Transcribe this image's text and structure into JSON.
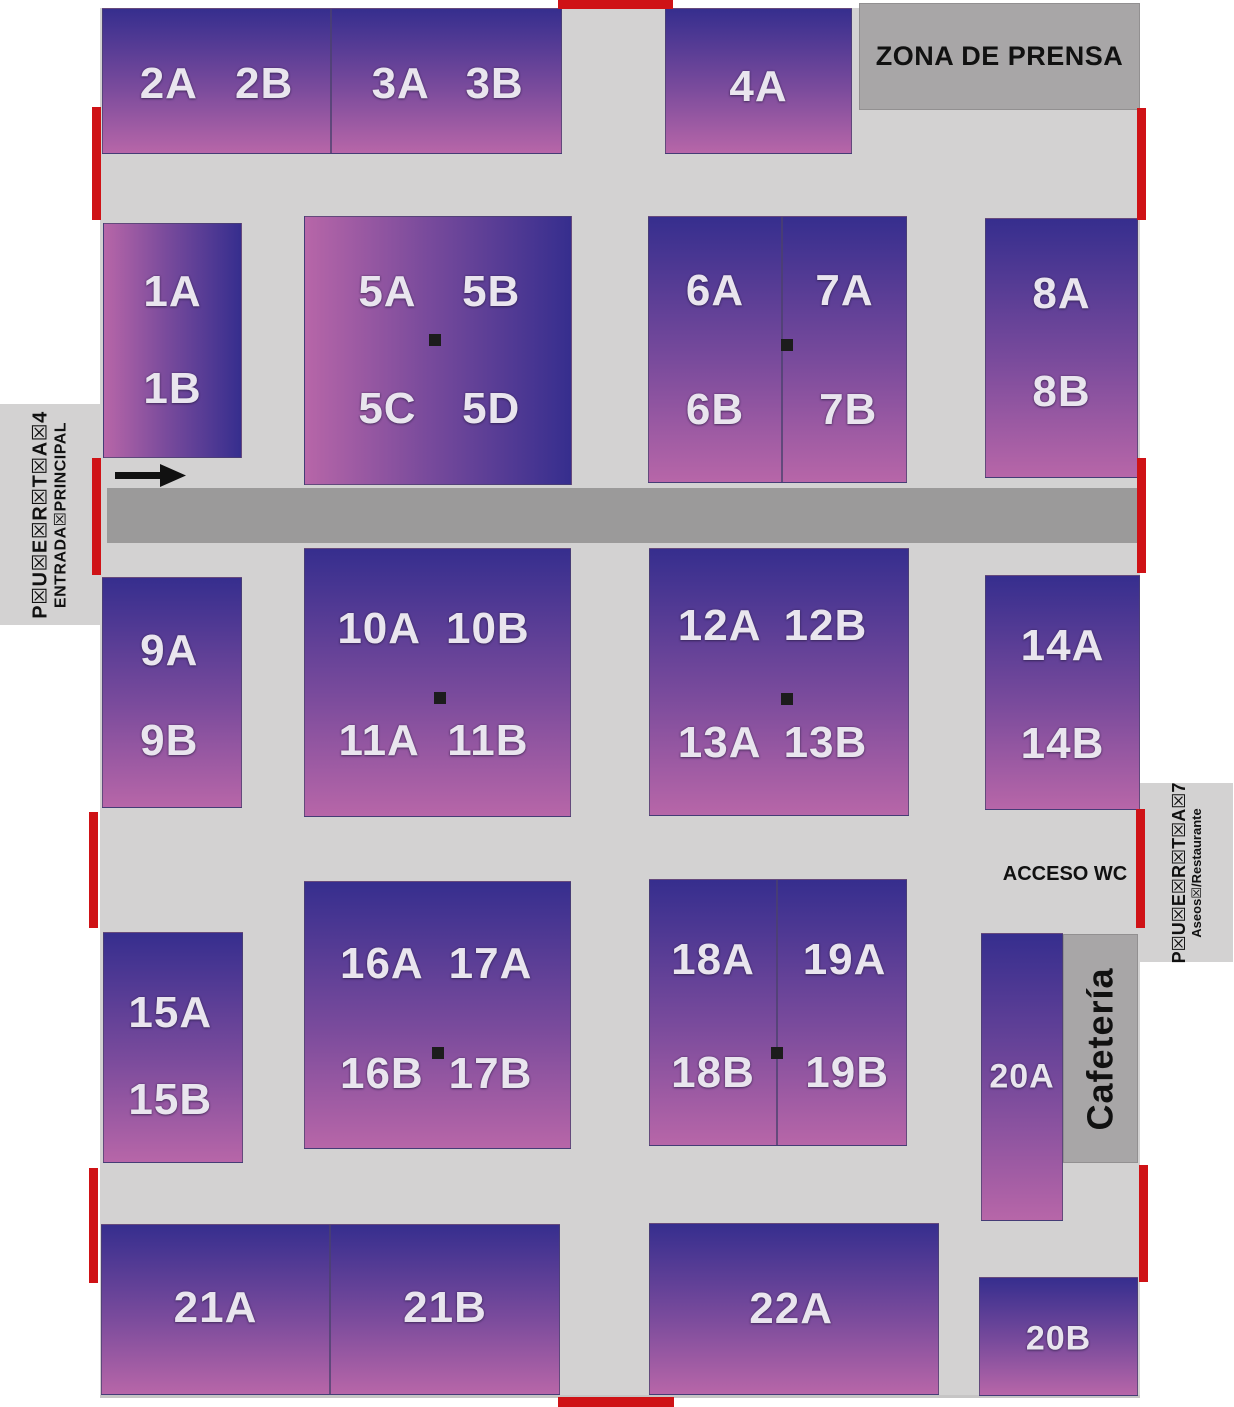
{
  "map": {
    "colors": {
      "floor_gray": "#d3d2d2",
      "corridor_gray": "#9b9a9a",
      "zone_gray": "#a8a6a7",
      "stand_gradient_dark": "#362e8e",
      "stand_gradient_pink": "#b766a8",
      "label_white": "#e9e5ee",
      "door_red": "#cf1216"
    },
    "zones": {
      "press": {
        "label": "ZONA DE PRENSA"
      },
      "cafeteria": {
        "label": "Cafetería"
      },
      "acceso_wc": {
        "label": "ACCESO WC"
      },
      "door4": {
        "line1": "P☒U☒E☒R☒T☒A☒4",
        "line2": "ENTRADA☒PRINCIPAL"
      },
      "door7": {
        "line1": "P☒U☒E☒R☒T☒A☒7",
        "line2": "Aseos☒/Restaurante"
      }
    },
    "stands": [
      {
        "id": "2",
        "x": 102,
        "y": 8,
        "w": 229,
        "h": 146,
        "grad": "v",
        "fs": 44,
        "labels": [
          {
            "t": "2A",
            "x": 29,
            "y": 52
          },
          {
            "t": "2B",
            "x": 71,
            "y": 52
          }
        ]
      },
      {
        "id": "3",
        "x": 331,
        "y": 8,
        "w": 231,
        "h": 146,
        "grad": "v",
        "fs": 44,
        "labels": [
          {
            "t": "3A",
            "x": 30,
            "y": 52
          },
          {
            "t": "3B",
            "x": 71,
            "y": 52
          }
        ]
      },
      {
        "id": "4",
        "x": 665,
        "y": 8,
        "w": 187,
        "h": 146,
        "grad": "v",
        "fs": 44,
        "labels": [
          {
            "t": "4A",
            "x": 50,
            "y": 54
          }
        ]
      },
      {
        "id": "1",
        "x": 103,
        "y": 223,
        "w": 139,
        "h": 235,
        "grad": "h",
        "fs": 44,
        "labels": [
          {
            "t": "1A",
            "x": 50,
            "y": 29
          },
          {
            "t": "1B",
            "x": 50,
            "y": 71
          }
        ]
      },
      {
        "id": "5",
        "x": 304,
        "y": 216,
        "w": 268,
        "h": 269,
        "grad": "h",
        "fs": 44,
        "labels": [
          {
            "t": "5A",
            "x": 31,
            "y": 28
          },
          {
            "t": "5B",
            "x": 70,
            "y": 28
          },
          {
            "t": "5C",
            "x": 31,
            "y": 72
          },
          {
            "t": "5D",
            "x": 70,
            "y": 72
          }
        ]
      },
      {
        "id": "6",
        "x": 648,
        "y": 216,
        "w": 134,
        "h": 267,
        "grad": "v",
        "fs": 44,
        "labels": [
          {
            "t": "6A",
            "x": 50,
            "y": 28
          },
          {
            "t": "6B",
            "x": 50,
            "y": 73
          }
        ]
      },
      {
        "id": "7",
        "x": 782,
        "y": 216,
        "w": 125,
        "h": 267,
        "grad": "v",
        "fs": 44,
        "labels": [
          {
            "t": "7A",
            "x": 50,
            "y": 28
          },
          {
            "t": "7B",
            "x": 53,
            "y": 73
          }
        ]
      },
      {
        "id": "8",
        "x": 985,
        "y": 218,
        "w": 153,
        "h": 260,
        "grad": "v",
        "fs": 44,
        "labels": [
          {
            "t": "8A",
            "x": 50,
            "y": 29
          },
          {
            "t": "8B",
            "x": 50,
            "y": 67
          }
        ]
      },
      {
        "id": "9",
        "x": 102,
        "y": 577,
        "w": 140,
        "h": 231,
        "grad": "v",
        "fs": 44,
        "labels": [
          {
            "t": "9A",
            "x": 48,
            "y": 32
          },
          {
            "t": "9B",
            "x": 48,
            "y": 71
          }
        ]
      },
      {
        "id": "10-11",
        "x": 304,
        "y": 548,
        "w": 267,
        "h": 269,
        "grad": "v",
        "fs": 44,
        "labels": [
          {
            "t": "10A",
            "x": 28,
            "y": 30
          },
          {
            "t": "10B",
            "x": 69,
            "y": 30
          },
          {
            "t": "11A",
            "x": 28,
            "y": 72
          },
          {
            "t": "11B",
            "x": 69,
            "y": 72
          }
        ]
      },
      {
        "id": "12-13",
        "x": 649,
        "y": 548,
        "w": 260,
        "h": 268,
        "grad": "v",
        "fs": 44,
        "labels": [
          {
            "t": "12A",
            "x": 27,
            "y": 29
          },
          {
            "t": "12B",
            "x": 68,
            "y": 29
          },
          {
            "t": "13A",
            "x": 27,
            "y": 73
          },
          {
            "t": "13B",
            "x": 68,
            "y": 73
          }
        ]
      },
      {
        "id": "14",
        "x": 985,
        "y": 575,
        "w": 155,
        "h": 235,
        "grad": "v",
        "fs": 44,
        "labels": [
          {
            "t": "14A",
            "x": 50,
            "y": 30
          },
          {
            "t": "14B",
            "x": 50,
            "y": 72
          }
        ]
      },
      {
        "id": "15",
        "x": 103,
        "y": 932,
        "w": 140,
        "h": 231,
        "grad": "v",
        "fs": 44,
        "labels": [
          {
            "t": "15A",
            "x": 48,
            "y": 35
          },
          {
            "t": "15B",
            "x": 48,
            "y": 73
          }
        ]
      },
      {
        "id": "16-17",
        "x": 304,
        "y": 881,
        "w": 267,
        "h": 268,
        "grad": "v",
        "fs": 44,
        "labels": [
          {
            "t": "16A",
            "x": 29,
            "y": 31
          },
          {
            "t": "17A",
            "x": 70,
            "y": 31
          },
          {
            "t": "16B",
            "x": 29,
            "y": 72
          },
          {
            "t": "17B",
            "x": 70,
            "y": 72
          }
        ]
      },
      {
        "id": "18",
        "x": 649,
        "y": 879,
        "w": 128,
        "h": 267,
        "grad": "v",
        "fs": 44,
        "labels": [
          {
            "t": "18A",
            "x": 50,
            "y": 30
          },
          {
            "t": "18B",
            "x": 50,
            "y": 73
          }
        ]
      },
      {
        "id": "19",
        "x": 777,
        "y": 879,
        "w": 130,
        "h": 267,
        "grad": "v",
        "fs": 44,
        "labels": [
          {
            "t": "19A",
            "x": 52,
            "y": 30
          },
          {
            "t": "19B",
            "x": 54,
            "y": 73
          }
        ]
      },
      {
        "id": "20A",
        "x": 981,
        "y": 933,
        "w": 82,
        "h": 288,
        "grad": "v",
        "fs": 34,
        "labels": [
          {
            "t": "20A",
            "x": 50,
            "y": 50
          }
        ]
      },
      {
        "id": "21A",
        "x": 101,
        "y": 1224,
        "w": 229,
        "h": 171,
        "grad": "v",
        "fs": 44,
        "labels": [
          {
            "t": "21A",
            "x": 50,
            "y": 49
          }
        ]
      },
      {
        "id": "21B",
        "x": 330,
        "y": 1224,
        "w": 230,
        "h": 171,
        "grad": "v",
        "fs": 44,
        "labels": [
          {
            "t": "21B",
            "x": 50,
            "y": 49
          }
        ]
      },
      {
        "id": "22",
        "x": 649,
        "y": 1223,
        "w": 290,
        "h": 172,
        "grad": "v",
        "fs": 44,
        "labels": [
          {
            "t": "22A",
            "x": 49,
            "y": 50
          }
        ]
      },
      {
        "id": "20B",
        "x": 979,
        "y": 1277,
        "w": 159,
        "h": 119,
        "grad": "v",
        "fs": 34,
        "labels": [
          {
            "t": "20B",
            "x": 50,
            "y": 52
          }
        ]
      }
    ],
    "pillars": [
      {
        "x": 435,
        "y": 340
      },
      {
        "x": 787,
        "y": 345
      },
      {
        "x": 440,
        "y": 698
      },
      {
        "x": 787,
        "y": 699
      },
      {
        "x": 438,
        "y": 1053
      },
      {
        "x": 777,
        "y": 1053
      }
    ],
    "doors": [
      {
        "x": 558,
        "y": 0,
        "w": 115,
        "h": 9
      },
      {
        "x": 558,
        "y": 1397,
        "w": 116,
        "h": 10
      },
      {
        "x": 92,
        "y": 107,
        "w": 9,
        "h": 113
      },
      {
        "x": 92,
        "y": 458,
        "w": 9,
        "h": 117
      },
      {
        "x": 89,
        "y": 812,
        "w": 9,
        "h": 116
      },
      {
        "x": 89,
        "y": 1168,
        "w": 9,
        "h": 115
      },
      {
        "x": 1137,
        "y": 108,
        "w": 9,
        "h": 112
      },
      {
        "x": 1137,
        "y": 458,
        "w": 9,
        "h": 115
      },
      {
        "x": 1136,
        "y": 809,
        "w": 9,
        "h": 119
      },
      {
        "x": 1139,
        "y": 1165,
        "w": 9,
        "h": 117
      }
    ]
  }
}
